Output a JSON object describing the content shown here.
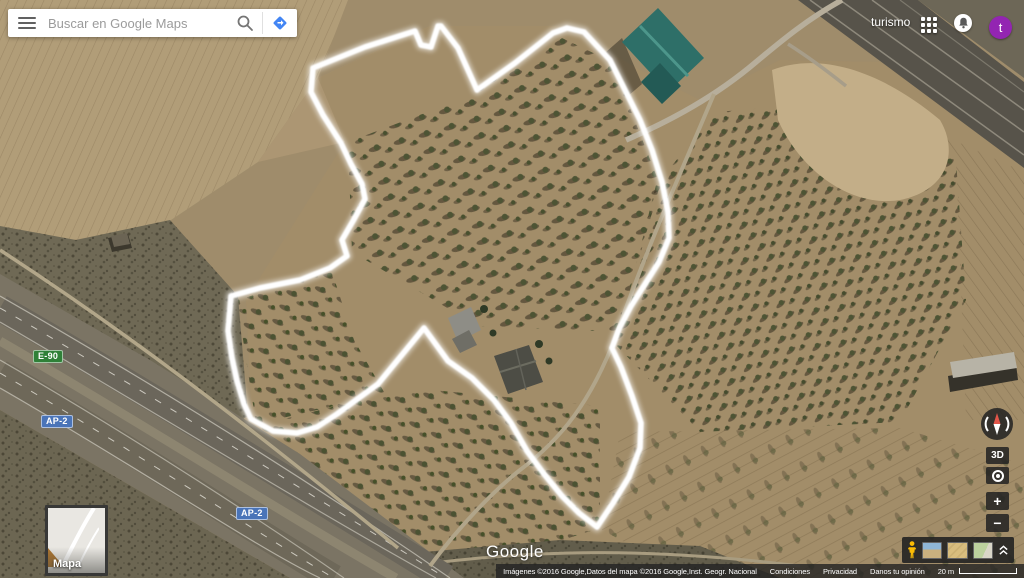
{
  "topbar": {
    "search_placeholder": "Buscar en Google Maps",
    "account_name": "turismo",
    "avatar_letter": "t"
  },
  "map": {
    "logo": "Google",
    "thumb_label": "Mapa",
    "shields": [
      {
        "label": "E-90",
        "color": "#2f8038",
        "x": 33,
        "y": 350
      },
      {
        "label": "AP-2",
        "color": "#4a74b8",
        "x": 41,
        "y": 415
      },
      {
        "label": "AP-2",
        "color": "#4a74b8",
        "x": 236,
        "y": 507
      }
    ]
  },
  "controls": {
    "threed_label": "3D",
    "zoom_in": "+",
    "zoom_out": "−"
  },
  "attribution": {
    "imagery": "Imágenes ©2016 Google,Datos del mapa ©2016 Google,Inst. Geogr. Nacional",
    "terms": "Condiciones",
    "privacy": "Privacidad",
    "feedback": "Danos tu opinión",
    "scale_label": "20 m"
  },
  "scene": {
    "track_points": "313,68 365,47 415,31 421,45 431,47 438,26 441,26 458,48 477,90 515,63 553,33 567,28 584,32 610,60 625,90 640,120 652,150 662,182 668,212 669,238 659,262 645,284 631,306 619,329 612,348 621,367 632,396 641,423 640,448 629,477 613,503 597,527 579,513 562,496 544,474 527,451 511,423 494,400 472,378 448,361 424,328 401,356 378,384 356,400 337,414 317,427 297,433 273,431 251,419 244,404 237,381 232,358 228,331 231,296 260,288 300,280 330,268 347,256 342,240 353,221 365,199 362,184 351,164 341,143 323,115 311,92",
    "layers": [
      {
        "name": "base-ground",
        "el": "rect",
        "attrs": {
          "x": "0",
          "y": "0",
          "width": "1024",
          "height": "578",
          "fill": "#9f8c6b"
        }
      },
      {
        "name": "field-topleft",
        "el": "polygon",
        "attrs": {
          "points": "0,0 348,0 318,78 258,162 168,222 74,240 0,228",
          "fill": "#b19d78"
        }
      },
      {
        "name": "field-topleft-furrows",
        "el": "polygon",
        "attrs": {
          "points": "0,0 348,0 318,78 258,162 168,222 74,240 0,228",
          "fill": "url(#furrowA)"
        }
      },
      {
        "name": "field-topmid",
        "el": "polygon",
        "attrs": {
          "points": "318,78 430,26 470,92 430,160 345,142 258,162",
          "fill": "#ac9673"
        }
      },
      {
        "name": "grove-area-main",
        "el": "polygon",
        "attrs": {
          "points": "246,300 345,142 318,78 430,26 565,26 640,70 700,100 780,60 880,62 1024,150 1024,578 460,578 252,425",
          "fill": "#a28d69"
        }
      },
      {
        "name": "grove-center",
        "el": "polygon",
        "attrs": {
          "points": "348,142 470,96 562,38 612,62 660,185 618,332 478,326 352,252",
          "fill": "url(#treesA)"
        }
      },
      {
        "name": "grove-right",
        "el": "polygon",
        "attrs": {
          "points": "616,345 656,185 716,112 865,100 956,160 966,300 900,422 700,432",
          "fill": "url(#treesB)"
        }
      },
      {
        "name": "field-right-edge",
        "el": "polygon",
        "attrs": {
          "points": "865,100 1024,172 1024,420 966,420 956,160",
          "fill": "url(#furrowB)"
        }
      },
      {
        "name": "grove-left-small",
        "el": "polygon",
        "attrs": {
          "points": "237,300 332,272 354,340 384,392 352,402 256,424",
          "fill": "url(#treesC)"
        }
      },
      {
        "name": "grove-bottom-mid",
        "el": "polygon",
        "attrs": {
          "points": "256,426 352,402 432,390 600,406 600,528 456,574 332,506",
          "fill": "url(#treesC)"
        }
      },
      {
        "name": "field-bottom-right",
        "el": "polygon",
        "attrs": {
          "points": "620,432 900,428 1024,464 1024,578 692,578 602,530",
          "fill": "url(#furrowC)"
        }
      },
      {
        "name": "grove-bottom-right",
        "el": "polygon",
        "attrs": {
          "points": "620,432 900,428 1024,464 1024,578 692,578 602,530",
          "fill": "url(#treesD)",
          "opacity": "0.55"
        }
      },
      {
        "name": "scrub-wedge",
        "el": "polygon",
        "attrs": {
          "points": "0,226 76,240 170,220 238,296 248,416 196,446 96,360 0,300",
          "fill": "#6f6955"
        }
      },
      {
        "name": "scrub-wedge-noise",
        "el": "polygon",
        "attrs": {
          "points": "0,226 76,240 170,220 238,296 248,416 196,446 96,360 0,300",
          "fill": "url(#noise)"
        }
      },
      {
        "name": "scrub-bottom-strip",
        "el": "polygon",
        "attrs": {
          "points": "378,556 560,540 700,546 780,578 392,578",
          "fill": "#625d4b"
        }
      },
      {
        "name": "scrub-bottom-noise",
        "el": "polygon",
        "attrs": {
          "points": "378,556 560,540 700,546 780,578 392,578",
          "fill": "url(#noise)"
        }
      },
      {
        "name": "road-bottom",
        "el": "path",
        "attrs": {
          "d": "M395,568 C520,550 640,546 800,566",
          "stroke": "#a89c80",
          "stroke-width": "3",
          "fill": "none"
        }
      },
      {
        "name": "highway-corridor",
        "el": "polygon",
        "attrs": {
          "points": "0,274 150,360 300,454 464,578 290,578 138,490 0,410",
          "fill": "#7b7464"
        }
      },
      {
        "name": "highway-carriageway-upper",
        "el": "path",
        "attrs": {
          "d": "M0,308 C150,394 300,488 446,578",
          "stroke": "#6b665b",
          "stroke-width": "27",
          "fill": "none"
        }
      },
      {
        "name": "highway-median",
        "el": "path",
        "attrs": {
          "d": "M0,341 C145,425 285,515 396,578",
          "stroke": "#8d8570",
          "stroke-width": "9",
          "fill": "none"
        }
      },
      {
        "name": "highway-carriageway-lower",
        "el": "path",
        "attrs": {
          "d": "M0,373 C140,454 268,540 334,578",
          "stroke": "#6e6859",
          "stroke-width": "27",
          "fill": "none"
        }
      },
      {
        "name": "highway-edge-1",
        "el": "path",
        "attrs": {
          "d": "M0,296 C150,382 302,476 450,578",
          "stroke": "rgba(225,222,210,0.6)",
          "stroke-width": "1.2",
          "fill": "none"
        }
      },
      {
        "name": "highway-dash-1",
        "el": "path",
        "attrs": {
          "d": "M0,308 C150,394 300,488 446,578",
          "stroke": "rgba(238,235,225,0.75)",
          "stroke-width": "1",
          "fill": "none",
          "stroke-dasharray": "7 11"
        }
      },
      {
        "name": "highway-edge-2",
        "el": "path",
        "attrs": {
          "d": "M0,322 C148,408 296,500 436,578",
          "stroke": "rgba(225,222,210,0.55)",
          "stroke-width": "1.2",
          "fill": "none"
        }
      },
      {
        "name": "highway-edge-3",
        "el": "path",
        "attrs": {
          "d": "M0,360 C142,442 272,528 344,578",
          "stroke": "rgba(225,222,210,0.55)",
          "stroke-width": "1.2",
          "fill": "none"
        }
      },
      {
        "name": "highway-dash-2",
        "el": "path",
        "attrs": {
          "d": "M0,373 C140,454 268,540 334,578",
          "stroke": "rgba(238,235,225,0.75)",
          "stroke-width": "1",
          "fill": "none",
          "stroke-dasharray": "7 11"
        }
      },
      {
        "name": "highway-edge-4",
        "el": "path",
        "attrs": {
          "d": "M0,388 C136,466 260,550 320,578",
          "stroke": "rgba(225,222,210,0.6)",
          "stroke-width": "1.2",
          "fill": "none"
        }
      },
      {
        "name": "service-road",
        "el": "path",
        "attrs": {
          "d": "M0,250 C120,328 240,418 398,548",
          "stroke": "#b2a689",
          "stroke-width": "3.5",
          "fill": "none"
        }
      },
      {
        "name": "scrub-below-highway",
        "el": "polygon",
        "attrs": {
          "points": "0,410 138,490 290,578 0,578",
          "fill": "#6c6652"
        }
      },
      {
        "name": "scrub-below-highway-noise",
        "el": "polygon",
        "attrs": {
          "points": "0,410 138,490 290,578 0,578",
          "fill": "url(#noise)"
        }
      },
      {
        "name": "rail-corridor",
        "el": "polygon",
        "attrs": {
          "points": "798,0 918,0 1024,82 1024,168",
          "fill": "#57534a"
        }
      },
      {
        "name": "rail-line-1",
        "el": "path",
        "attrs": {
          "d": "M810,0 L1024,155",
          "stroke": "#8e897c",
          "stroke-width": "1.5",
          "fill": "none"
        }
      },
      {
        "name": "rail-line-2",
        "el": "path",
        "attrs": {
          "d": "M840,0 L1024,132",
          "stroke": "#8e897c",
          "stroke-width": "1.5",
          "fill": "none"
        }
      },
      {
        "name": "rail-line-3",
        "el": "path",
        "attrs": {
          "d": "M872,0 L1024,110",
          "stroke": "#8e897c",
          "stroke-width": "1.5",
          "fill": "none"
        }
      },
      {
        "name": "rail-line-4",
        "el": "path",
        "attrs": {
          "d": "M900,0 L1024,92",
          "stroke": "#7c786c",
          "stroke-width": "1.2",
          "fill": "none"
        }
      },
      {
        "name": "corner-above-rail",
        "el": "polygon",
        "attrs": {
          "points": "918,0 1024,0 1024,78",
          "fill": "#6d6757"
        }
      },
      {
        "name": "field-pale-blob",
        "el": "path",
        "attrs": {
          "d": "M772,70 C820,52 880,70 940,120 C958,150 950,190 900,200 C850,208 800,170 778,120 Z",
          "fill": "#c3ae88"
        }
      },
      {
        "name": "road-topright",
        "el": "path",
        "attrs": {
          "d": "M626,140 C672,120 716,96 756,62 C780,42 806,20 842,0",
          "stroke": "#b7ae9b",
          "stroke-width": "5.5",
          "fill": "none"
        }
      },
      {
        "name": "road-topright-spur",
        "el": "path",
        "attrs": {
          "d": "M788,44 C810,58 826,70 846,86",
          "stroke": "#a79d89",
          "stroke-width": "3.5",
          "fill": "none"
        }
      },
      {
        "name": "farm-road",
        "el": "path",
        "attrs": {
          "d": "M714,94 C682,170 650,240 618,330 C592,402 560,440 520,470 C492,492 458,528 430,566",
          "stroke": "#b1a58a",
          "stroke-width": "4",
          "fill": "none"
        }
      },
      {
        "name": "shed-left-shadow",
        "el": "polygon",
        "attrs": {
          "points": "108,238 128,234 132,248 112,252",
          "fill": "#3c382d"
        }
      },
      {
        "name": "shed-left",
        "el": "polygon",
        "attrs": {
          "points": "111,236 127,233 130,244 114,247",
          "fill": "#6b6454"
        }
      },
      {
        "name": "warehouse-shadow",
        "el": "polygon",
        "attrs": {
          "points": "606,52 622,38 642,84 628,96",
          "fill": "rgba(35,33,26,0.45)"
        }
      },
      {
        "name": "warehouse-teal",
        "el": "polygon",
        "attrs": {
          "points": "622,42 658,8 704,58 668,92",
          "fill": "#2e6f68"
        }
      },
      {
        "name": "warehouse-ridge",
        "el": "path",
        "attrs": {
          "d": "M640,26 L688,76",
          "stroke": "#4d968b",
          "stroke-width": "3",
          "fill": "none"
        }
      },
      {
        "name": "warehouse-annex",
        "el": "polygon",
        "attrs": {
          "points": "641,82 660,63 681,86 662,104",
          "fill": "#235a55"
        }
      },
      {
        "name": "farm-building-grey",
        "el": "polygon",
        "attrs": {
          "points": "448,318 471,307 481,330 458,342",
          "fill": "#8e8d86"
        }
      },
      {
        "name": "farm-building-grey-2",
        "el": "polygon",
        "attrs": {
          "points": "452,339 469,330 477,345 460,353",
          "fill": "#6f6e66"
        }
      },
      {
        "name": "farm-house",
        "el": "polygon",
        "attrs": {
          "points": "494,356 529,345 543,382 508,394",
          "fill": "#4d4d45"
        }
      },
      {
        "name": "farm-house-ridge",
        "el": "path",
        "attrs": {
          "d": "M500,372 L536,361",
          "stroke": "#6c6c60",
          "stroke-width": "2",
          "fill": "none"
        }
      },
      {
        "name": "farm-house-ridge-2",
        "el": "path",
        "attrs": {
          "d": "M516,349 L526,390",
          "stroke": "#63635a",
          "stroke-width": "1.5",
          "fill": "none"
        }
      },
      {
        "name": "cypress-1",
        "el": "circle",
        "attrs": {
          "cx": "484",
          "cy": "309",
          "r": "4",
          "fill": "#2f3a26"
        }
      },
      {
        "name": "cypress-2",
        "el": "circle",
        "attrs": {
          "cx": "493",
          "cy": "333",
          "r": "3.5",
          "fill": "#2f3a26"
        }
      },
      {
        "name": "cypress-3",
        "el": "circle",
        "attrs": {
          "cx": "539",
          "cy": "344",
          "r": "4",
          "fill": "#2f3a26"
        }
      },
      {
        "name": "cypress-4",
        "el": "circle",
        "attrs": {
          "cx": "549",
          "cy": "361",
          "r": "3.5",
          "fill": "#2f3a26"
        }
      },
      {
        "name": "right-shed-shadow",
        "el": "polygon",
        "attrs": {
          "points": "948,376 1016,364 1018,380 950,392",
          "fill": "#35322a"
        }
      },
      {
        "name": "right-shed",
        "el": "polygon",
        "attrs": {
          "points": "950,362 1014,352 1017,368 953,378",
          "fill": "#b7b3a6"
        }
      }
    ]
  }
}
